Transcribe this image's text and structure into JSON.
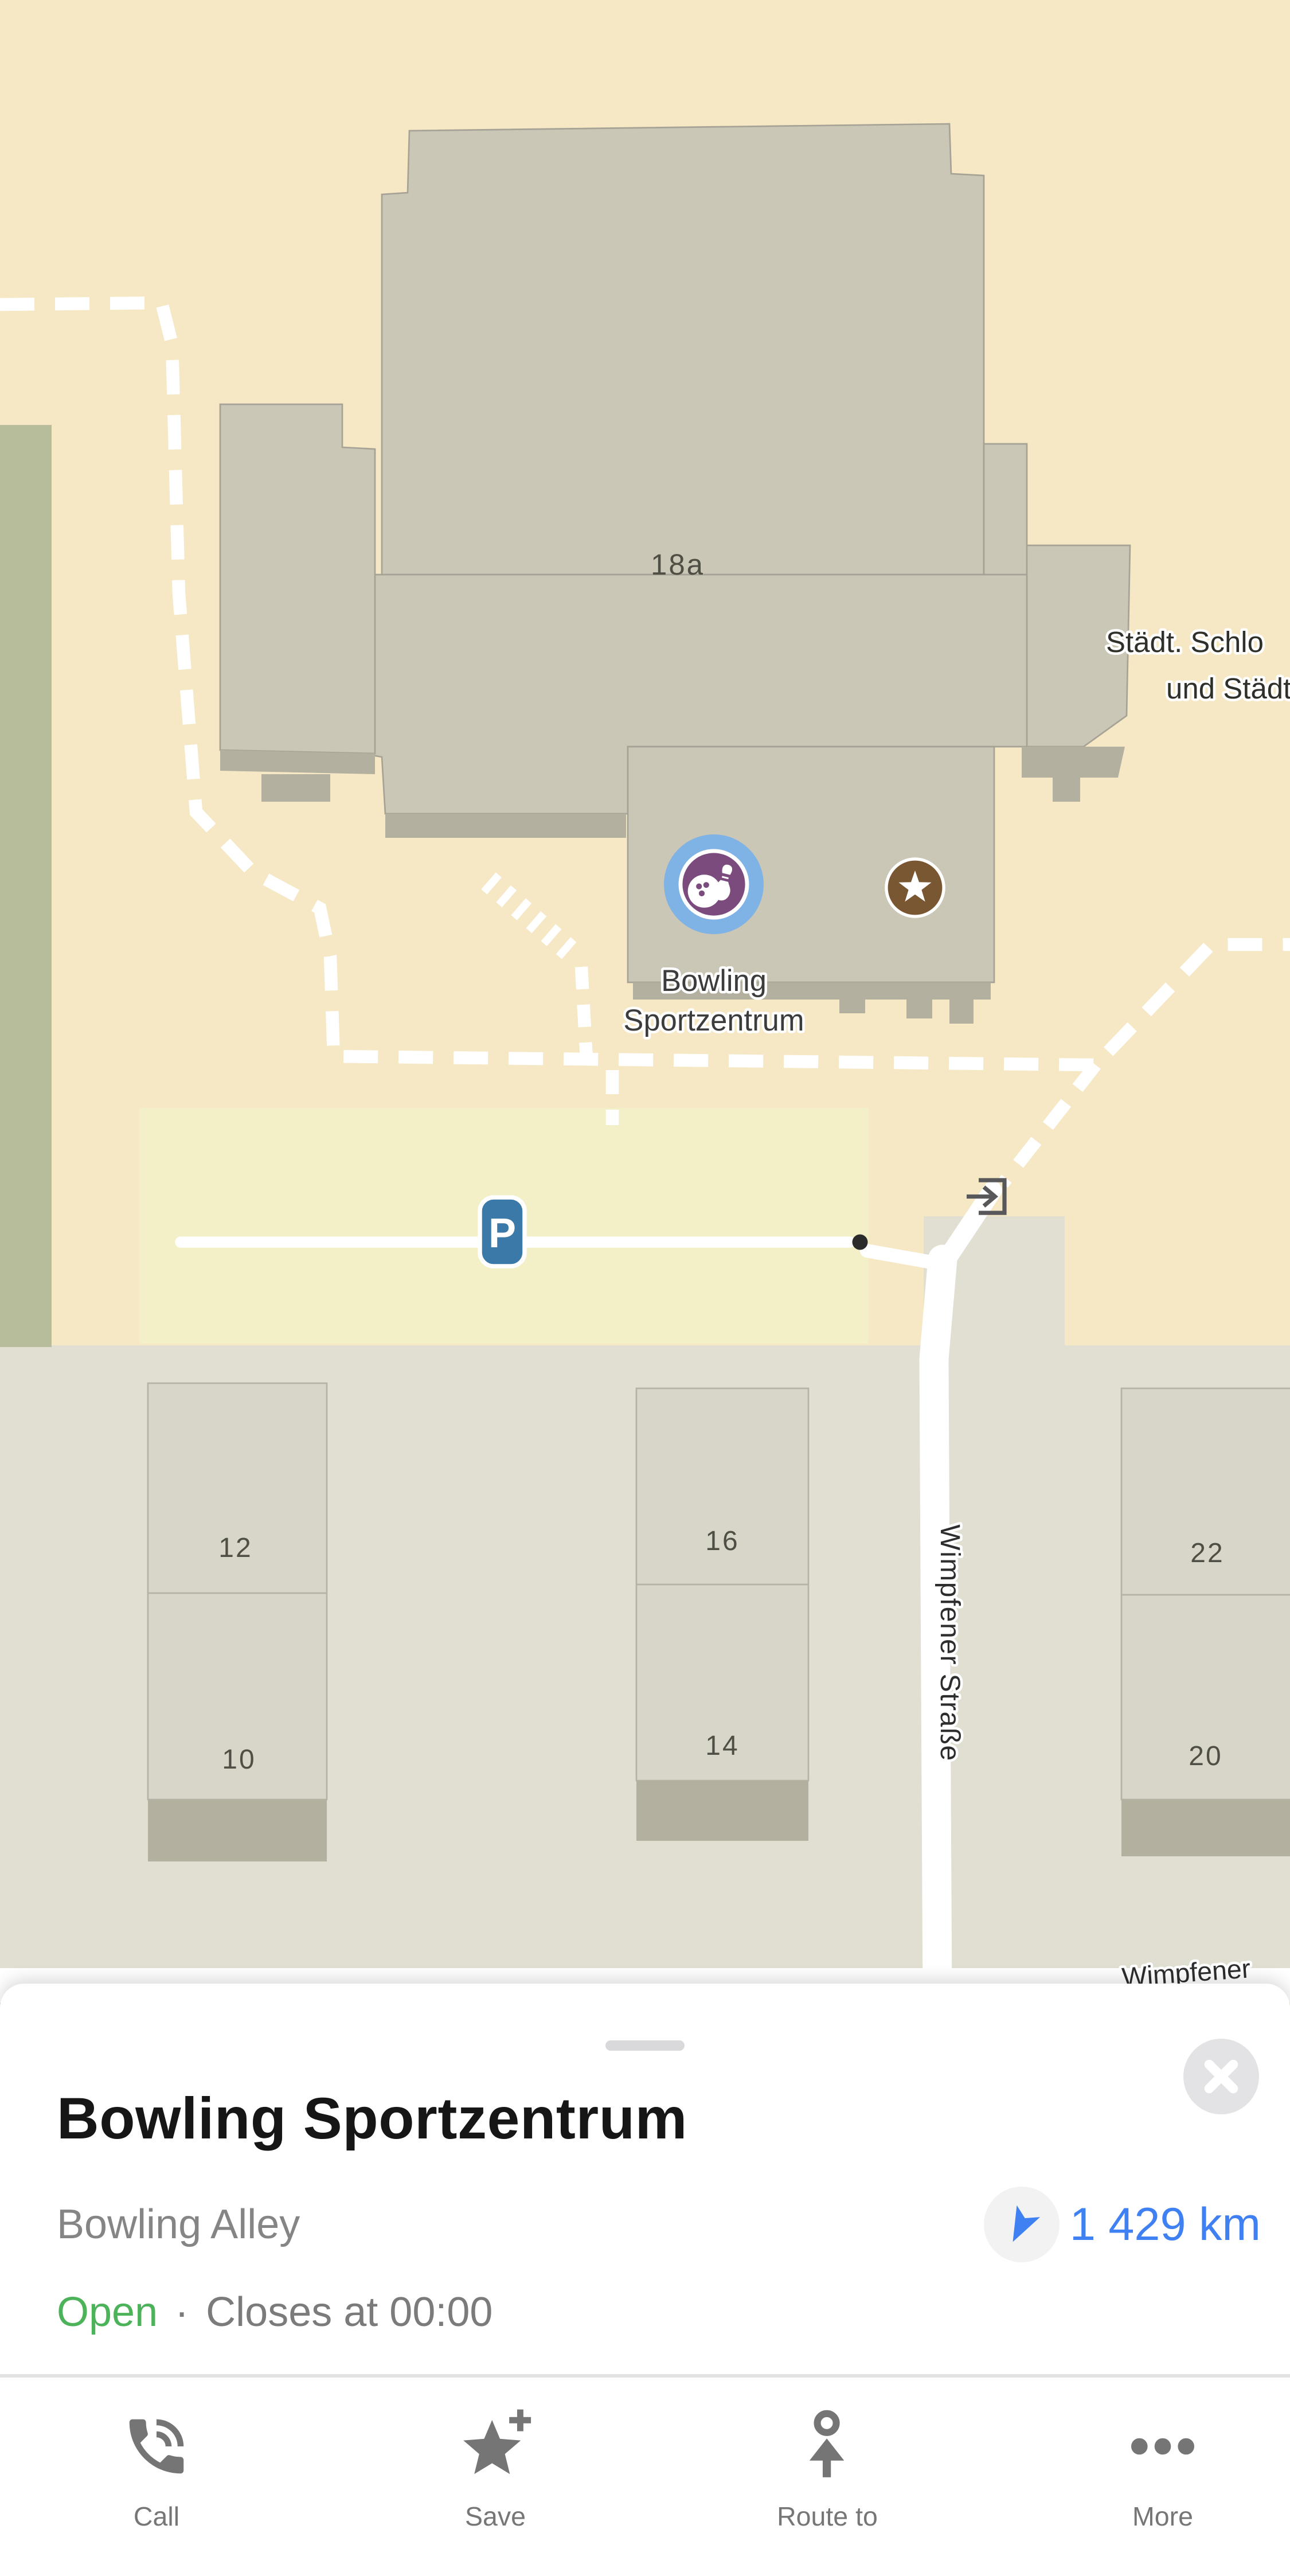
{
  "map": {
    "labels": {
      "house_main": "18a",
      "poi_truncated_line1": "Städt. Schlo",
      "poi_truncated_line2": "und Städt.",
      "place_line1": "Bowling",
      "place_line2": "Sportzentrum",
      "street_vertical": "Wimpfener Straße",
      "street_bottom": "Wimpfener",
      "parking": "P",
      "houses": [
        "12",
        "10",
        "16",
        "14",
        "22",
        "20"
      ]
    },
    "colors": {
      "land": "#f6e8c5",
      "district": "#e0dfd2",
      "green_area": "#b7bc9b",
      "parking_lot": "#f3efc6",
      "building": "#cbc7b6",
      "building_small": "#d8d6c8",
      "building_base": "#b3b09f",
      "road": "#ffffff",
      "poi_circle_blue": "#7fb2e5",
      "poi_inner_purple": "#7b4b7e",
      "star_brown": "#7a5733",
      "parking_sign_blue": "#3a79a8"
    }
  },
  "sheet": {
    "title": "Bowling Sportzentrum",
    "category": "Bowling Alley",
    "distance": "1 429 km",
    "status": {
      "open": "Open",
      "separator": "·",
      "closes": "Closes at 00:00"
    },
    "actions": [
      {
        "label": "Call"
      },
      {
        "label": "Save"
      },
      {
        "label": "Route to"
      },
      {
        "label": "More"
      }
    ],
    "colors": {
      "accent_blue": "#3f80f2",
      "open_green": "#4db35a"
    }
  }
}
